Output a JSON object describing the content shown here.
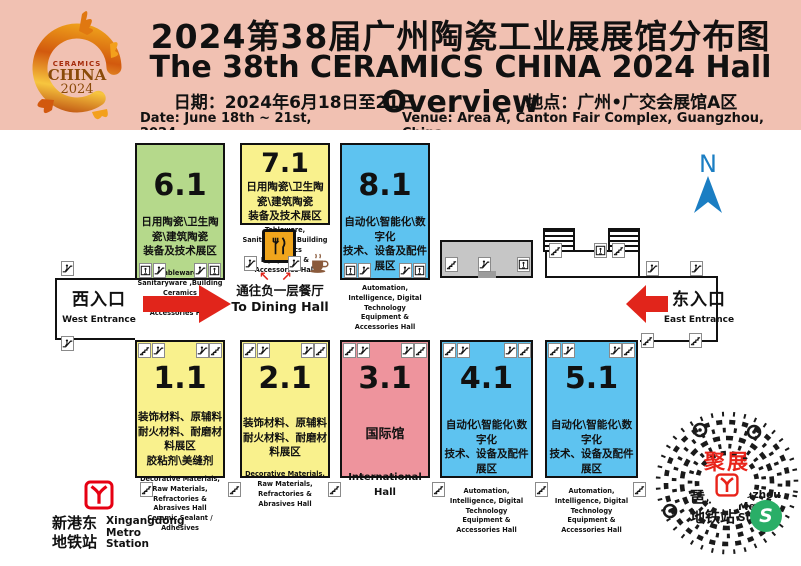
{
  "header": {
    "title_cn": "2024第38届广州陶瓷工业展展馆分布图",
    "title_en": "The 38th CERAMICS CHINA 2024 Hall Overview",
    "date_cn": "日期：2024年6月18日至21日",
    "venue_cn": "地点：广州•广交会展馆A区",
    "date_en": "Date:  June 18th ~ 21st, 2024",
    "venue_en": "Venue: Area A, Canton Fair Complex, Guangzhou, China",
    "logo": {
      "line1": "CERAMICS",
      "line2": "CHINA",
      "line3": "2024"
    }
  },
  "halls": [
    {
      "num": "6.1",
      "cn": "日用陶瓷\\卫生陶瓷\\建筑陶瓷\n装备及技术展区",
      "en": "Tableware, Sanitaryware ,Building Ceramics\nEquipment & Accessories Hall",
      "color": "#b5d98b"
    },
    {
      "num": "7.1",
      "cn": "日用陶瓷\\卫生陶瓷\\建筑陶瓷\n装备及技术展区",
      "en": "Tableware, Sanitaryware ,Building Ceramics\nEquipment & Accessories Hall",
      "color": "#f9f18d"
    },
    {
      "num": "8.1",
      "cn": "自动化\\智能化\\数字化\n技术、设备及配件展区",
      "en": "Automation, Intelligence, Digital Technology\nEquipment & Accessories Hall",
      "color": "#5ec3f0"
    },
    {
      "num": "1.1",
      "cn": "装饰材料、原辅料\n耐火材料、耐磨材料展区\n胶粘剂\\美缝剂",
      "en": "Decorative Materials, Raw Materials,\nRefractories & Abrasives Hall\nCeramic Sealant / Adhesives",
      "color": "#f9f18d"
    },
    {
      "num": "2.1",
      "cn": "装饰材料、原辅料\n耐火材料、耐磨材料展区",
      "en": "Decorative Materials, Raw Materials,\nRefractories & Abrasives Hall",
      "color": "#f9f18d"
    },
    {
      "num": "3.1",
      "cn": "国际馆",
      "en": "International Hall",
      "color": "#ee949d"
    },
    {
      "num": "4.1",
      "cn": "自动化\\智能化\\数字化\n技术、设备及配件展区",
      "en": "Automation, Intelligence, Digital Technology\nEquipment & Accessories Hall",
      "color": "#5ec3f0"
    },
    {
      "num": "5.1",
      "cn": "自动化\\智能化\\数字化\n技术、设备及配件展区",
      "en": "Automation, Intelligence, Digital Technology\nEquipment & Accessories Hall",
      "color": "#5ec3f0"
    }
  ],
  "entrances": {
    "west": {
      "cn": "西入口",
      "en": "West Entrance"
    },
    "east": {
      "cn": "东入口",
      "en": "East Entrance"
    }
  },
  "dining": {
    "cn": "通往负一层餐厅",
    "en": "To Dining Hall"
  },
  "compass": {
    "label": "N"
  },
  "metro": {
    "xingangdong": {
      "cn": "新港东\n地铁站",
      "en": "Xingangdong\nMetro\nStation"
    },
    "pazhou": {
      "cn": "琶洲\n地铁站",
      "en": "Pazhou\nMetro\nStation"
    }
  },
  "qr": {
    "center_text": "聚展",
    "badge_letter": "S"
  },
  "colors": {
    "header_bg": "#f1c1b2",
    "hall_green": "#b5d98b",
    "hall_yellow": "#f9f18d",
    "hall_blue": "#5ec3f0",
    "hall_pink": "#ee949d",
    "arrow_red": "#e1251b",
    "compass_blue": "#1b7ec3",
    "metro_red": "#e60012",
    "wechat_green": "#2aae67"
  }
}
